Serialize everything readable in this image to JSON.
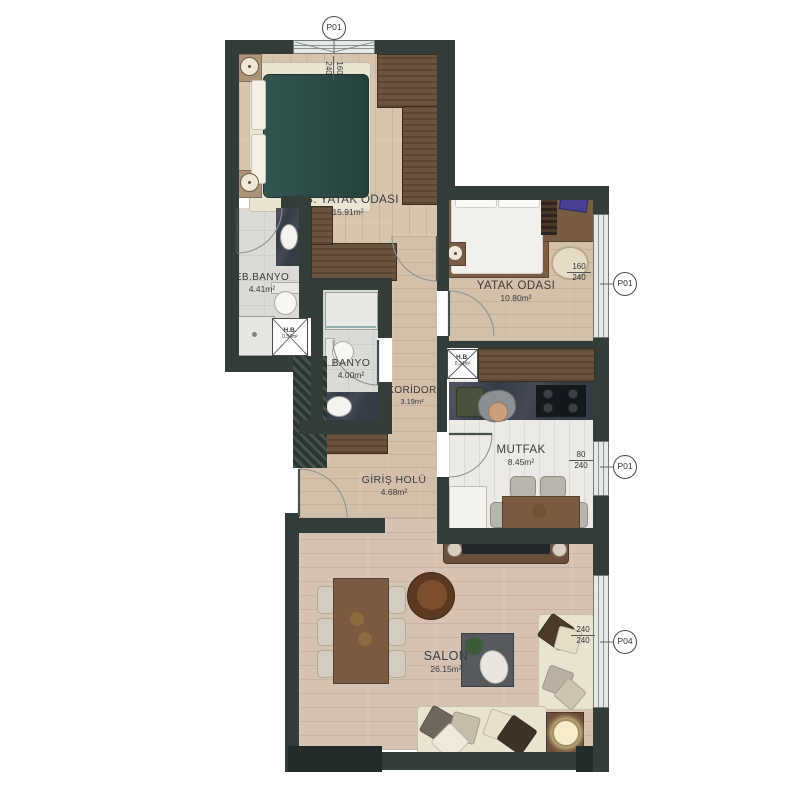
{
  "rooms": {
    "eb_yatak": {
      "name": "EB. YATAK ODASI",
      "area": "15.91m²"
    },
    "eb_banyo": {
      "name": "EB.BANYO",
      "area": "4.41m²"
    },
    "banyo": {
      "name": "BANYO",
      "area": "4.00m²"
    },
    "koridor": {
      "name": "KORİDOR",
      "area": "3.19m²"
    },
    "yatak": {
      "name": "YATAK ODASI",
      "area": "10.80m²"
    },
    "mutfak": {
      "name": "MUTFAK",
      "area": "8.45m²"
    },
    "giris": {
      "name": "GİRİŞ HOLÜ",
      "area": "4.68m²"
    },
    "salon": {
      "name": "SALON",
      "area": "26.15m²"
    }
  },
  "shafts": {
    "hb1": {
      "name": "H.B.",
      "area": "0,54m²"
    },
    "hb2": {
      "name": "H.B.",
      "area": "0,34m²"
    }
  },
  "openings": {
    "top": {
      "label": "P01",
      "w": "160",
      "h": "240"
    },
    "bedroom": {
      "label": "P01",
      "w": "160",
      "h": "240"
    },
    "kitchen": {
      "label": "P01",
      "w": "80",
      "h": "240"
    },
    "salon": {
      "label": "P04",
      "w": "240",
      "h": "240"
    }
  },
  "colors": {
    "wall": "#323c39",
    "wood_floor": "#d6c4ae",
    "salon_floor": "#d5c2b2",
    "tile_floor": "#dbdad6",
    "kitchen_floor": "#eceae6",
    "bed_teal": "#2c4a45",
    "wardrobe_wood": "#6b543f",
    "counter_dark": "#363b48"
  }
}
